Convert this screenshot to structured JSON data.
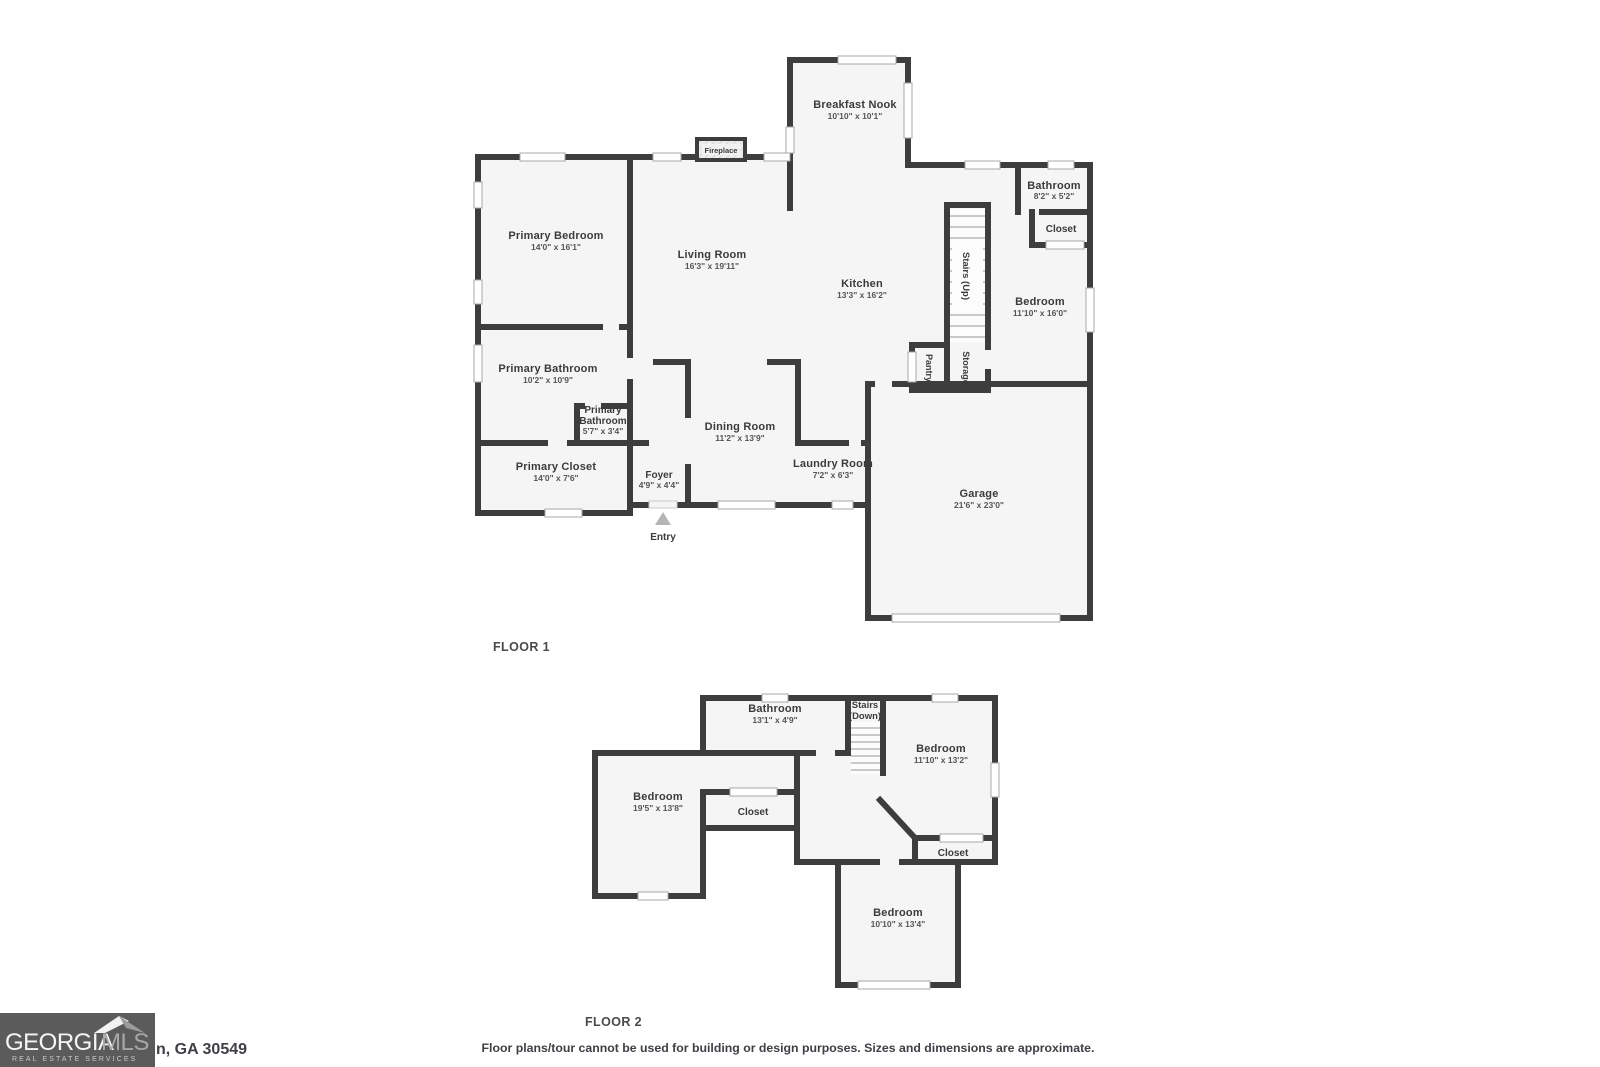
{
  "floor1": {
    "label": "FLOOR 1",
    "rooms": {
      "breakfast_nook": {
        "name": "Breakfast Nook",
        "dims": "10'10\" x 10'1\""
      },
      "primary_bedroom": {
        "name": "Primary Bedroom",
        "dims": "14'0\" x 16'1\""
      },
      "living_room": {
        "name": "Living Room",
        "dims": "16'3\" x 19'11\""
      },
      "kitchen": {
        "name": "Kitchen",
        "dims": "13'3\" x 16'2\""
      },
      "bathroom": {
        "name": "Bathroom",
        "dims": "8'2\" x 5'2\""
      },
      "closet": {
        "name": "Closet"
      },
      "bedroom": {
        "name": "Bedroom",
        "dims": "11'10\" x 16'0\""
      },
      "stairs": {
        "name": "Stairs (Up)"
      },
      "pantry": {
        "name": "Pantry"
      },
      "storage": {
        "name": "Storage"
      },
      "primary_bathroom": {
        "name": "Primary Bathroom",
        "dims": "10'2\" x 10'9\""
      },
      "primary_bathroom_small": {
        "line1": "Primary",
        "line2": "Bathroom",
        "dims": "5'7\" x 3'4\""
      },
      "primary_closet": {
        "name": "Primary Closet",
        "dims": "14'0\" x 7'6\""
      },
      "foyer": {
        "name": "Foyer",
        "dims": "4'9\" x 4'4\""
      },
      "dining_room": {
        "name": "Dining Room",
        "dims": "11'2\" x 13'9\""
      },
      "laundry_room": {
        "name": "Laundry Room",
        "dims": "7'2\" x 6'3\""
      },
      "garage": {
        "name": "Garage",
        "dims": "21'6\" x 23'0\""
      },
      "fireplace": {
        "name": "Fireplace"
      },
      "entry": {
        "name": "Entry"
      }
    }
  },
  "floor2": {
    "label": "FLOOR 2",
    "rooms": {
      "bathroom": {
        "name": "Bathroom",
        "dims": "13'1\" x 4'9\""
      },
      "stairs": {
        "line1": "Stairs",
        "line2": "(Down)"
      },
      "bedroom_right": {
        "name": "Bedroom",
        "dims": "11'10\" x 13'2\""
      },
      "bedroom_left": {
        "name": "Bedroom",
        "dims": "19'5\" x 13'8\""
      },
      "closet_left": {
        "name": "Closet"
      },
      "closet_right": {
        "name": "Closet"
      },
      "bedroom_bottom": {
        "name": "Bedroom",
        "dims": "10'10\" x 13'4\""
      }
    }
  },
  "footer": {
    "address_visible": "n, GA 30549",
    "disclaimer": "Floor plans/tour cannot be used for building or design purposes. Sizes and dimensions are approximate.",
    "logo": {
      "brand_part1": "GEORGIA",
      "brand_part2": "MLS",
      "tagline": "REAL ESTATE SERVICES"
    }
  },
  "colors": {
    "wall": "#3d3d3d",
    "room_fill": "#f5f5f5",
    "logo_background": "#5b5b5b",
    "text": "#3b3b3b"
  }
}
